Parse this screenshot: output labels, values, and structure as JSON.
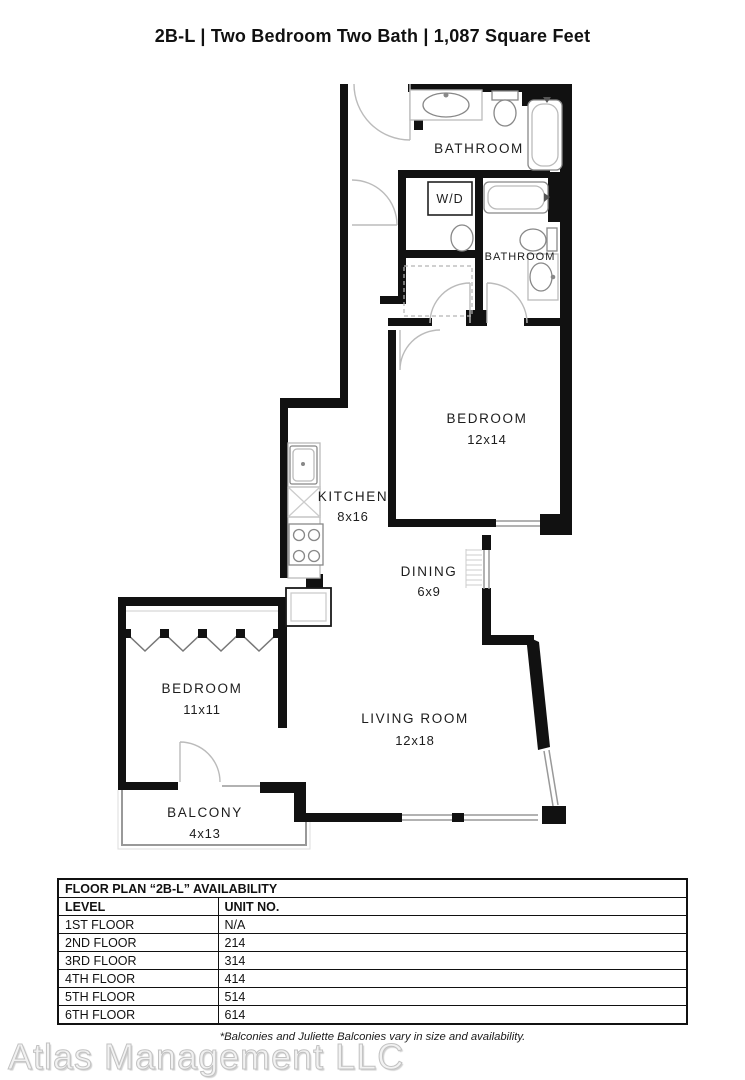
{
  "page_title": "2B-L | Two Bedroom Two Bath | 1,087 Square Feet",
  "floor_plan": {
    "rooms": [
      {
        "name": "BATHROOM",
        "dims": ""
      },
      {
        "name": "W/D",
        "dims": ""
      },
      {
        "name": "BATHROOM",
        "dims": ""
      },
      {
        "name": "BEDROOM",
        "dims": "12x14"
      },
      {
        "name": "KITCHEN",
        "dims": "8x16"
      },
      {
        "name": "DINING",
        "dims": "6x9"
      },
      {
        "name": "BEDROOM",
        "dims": "11x11"
      },
      {
        "name": "LIVING ROOM",
        "dims": "12x18"
      },
      {
        "name": "BALCONY",
        "dims": "4x13"
      }
    ]
  },
  "availability_table": {
    "title": "FLOOR PLAN “2B-L” AVAILABILITY",
    "columns": [
      "LEVEL",
      "UNIT NO."
    ],
    "rows": [
      {
        "level": "1ST FLOOR",
        "unit": "N/A"
      },
      {
        "level": "2ND FLOOR",
        "unit": "214"
      },
      {
        "level": "3RD FLOOR",
        "unit": "314"
      },
      {
        "level": "4TH FLOOR",
        "unit": "414"
      },
      {
        "level": "5TH FLOOR",
        "unit": "514"
      },
      {
        "level": "6TH FLOOR",
        "unit": "614"
      }
    ]
  },
  "footer": {
    "note": "*Balconies and Juliette Balconies vary in size and availability.",
    "company": "Atlas Management LLC"
  }
}
